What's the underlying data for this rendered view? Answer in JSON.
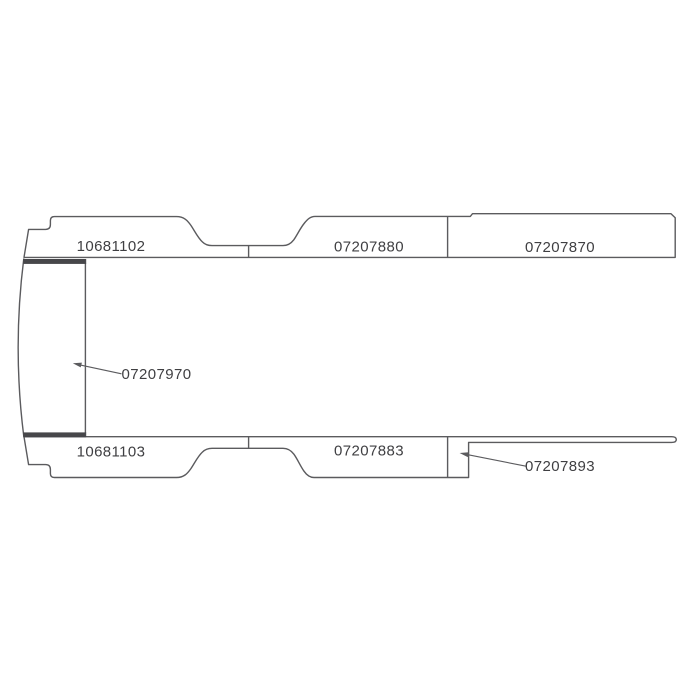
{
  "diagram": {
    "type": "vehicle-panel-parts-diagram",
    "colors": {
      "line": "#5b5b5e",
      "bar": "#47474a",
      "text": "#3f3f42",
      "background": "#ffffff"
    },
    "parts": [
      {
        "number": "10681102",
        "position": "top-strip-left",
        "has_leader_line": false
      },
      {
        "number": "07207880",
        "position": "top-strip-middle",
        "has_leader_line": false
      },
      {
        "number": "07207870",
        "position": "top-strip-right",
        "has_leader_line": false
      },
      {
        "number": "07207970",
        "position": "front-panel",
        "has_leader_line": true
      },
      {
        "number": "10681103",
        "position": "bottom-strip-left",
        "has_leader_line": false
      },
      {
        "number": "07207883",
        "position": "bottom-strip-middle",
        "has_leader_line": false
      },
      {
        "number": "07207893",
        "position": "bottom-strip-right-sill",
        "has_leader_line": true
      }
    ]
  }
}
